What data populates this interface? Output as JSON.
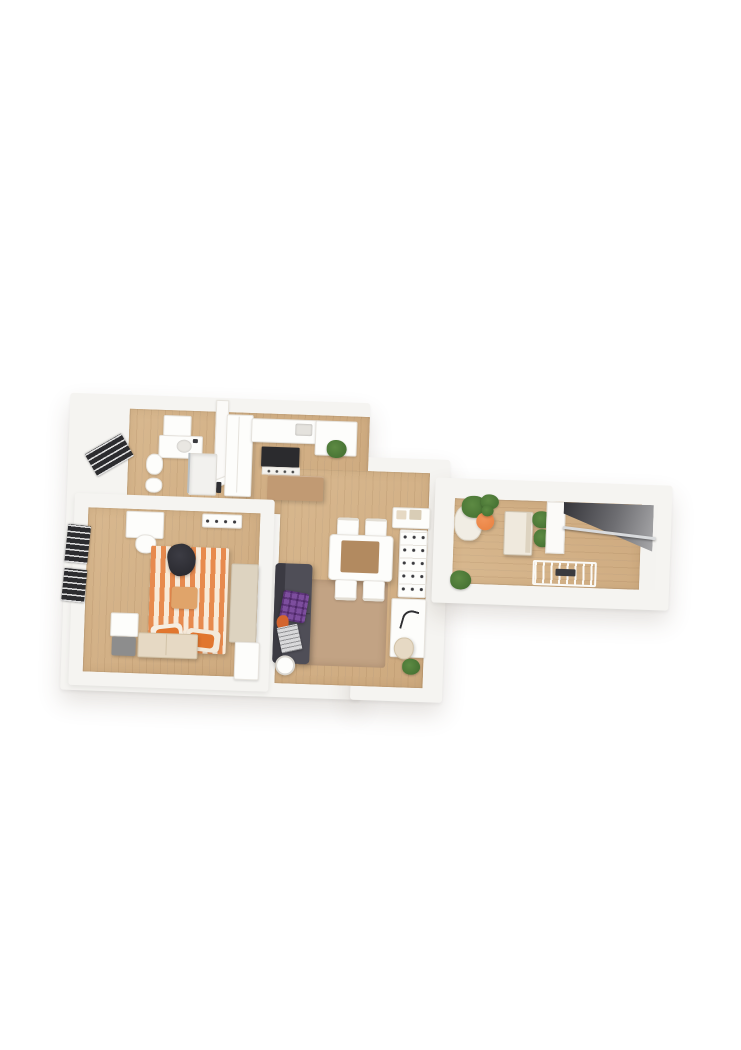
{
  "canvas": {
    "width": 741,
    "height": 1050,
    "background": "#ffffff",
    "content": "3D rendered top-down floor plan of an apartment, no visible text"
  },
  "palette": {
    "bg": "#ffffff",
    "wall": "#f5f4f1",
    "wallEdge": "#e6e3dd",
    "floor": "#cda97e",
    "floorHi": "#d8b88f",
    "rug": "#c2a384",
    "island": "#c19a73",
    "tableTop": "#b28a60",
    "stripeO": "#e78a4e",
    "stripeC": "#f8ead9",
    "pillowO": "#e1762f",
    "sofa": "#4f4e57",
    "sofaDk": "#3b3a42",
    "plaid": "#7d4e9e",
    "plant": "#5d8a43",
    "plantDk": "#3f6b2e",
    "pot": "#e8803f",
    "stairDk": "#35353a",
    "stairLt": "#a8a8aa",
    "rail": "#d9dbdd",
    "frame": "#2c2c2f",
    "cream": "#ddd3c0",
    "creamLt": "#efe9dd",
    "beige": "#e6d9c4",
    "grayBox": "#8d8d8d"
  },
  "scene": {
    "type": "3d-floorplan-render",
    "rotation_deg": 2,
    "rooms": [
      {
        "name": "bathroom",
        "furniture": [
          "wall-cabinet",
          "vanity-sink",
          "toilet",
          "bidet",
          "shower",
          "door"
        ]
      },
      {
        "name": "kitchen",
        "furniture": [
          "tall-cabinet",
          "counter",
          "sink",
          "cooktop-oven",
          "island",
          "counter-return",
          "potted-plant"
        ]
      },
      {
        "name": "bedroom",
        "furniture": [
          "desk",
          "desk-chair",
          "dresser",
          "window",
          "window",
          "bed-striped-duvet",
          "person-sitting",
          "cushion",
          "pillows",
          "wardrobe",
          "lower-cabinet",
          "storage-boxes",
          "gray-box",
          "bench"
        ]
      },
      {
        "name": "living-dining",
        "furniture": [
          "dining-table",
          "dining-chair",
          "dining-chair",
          "dining-chair",
          "dining-chair",
          "rug",
          "sofa",
          "plaid-blanket",
          "magazine",
          "orange-cushion",
          "floor-lamp",
          "sideboard",
          "shelf-unit",
          "desk",
          "desk-lamp",
          "chair",
          "potted-plant"
        ]
      },
      {
        "name": "entry-wing",
        "furniture": [
          "lounge-chair",
          "potted-plants",
          "orange-pot-plant",
          "storage-cabinet",
          "potted-plant",
          "partition-wall",
          "stairwell",
          "handrail",
          "drying-rack",
          "landing",
          "floor-plant"
        ]
      }
    ]
  }
}
